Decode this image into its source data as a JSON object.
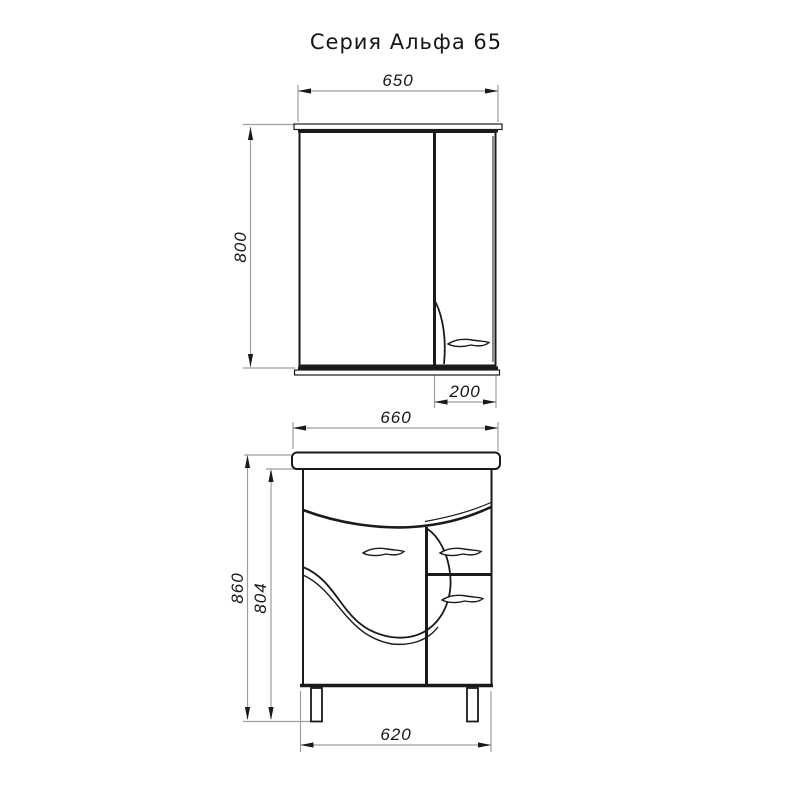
{
  "title": "Серия Альфа 65",
  "dimensions": {
    "mirror_width": "650",
    "mirror_height": "800",
    "mirror_side_cabinet_width": "200",
    "vanity_top_width": "660",
    "vanity_overall_height": "860",
    "vanity_body_height": "804",
    "vanity_base_width": "620"
  },
  "colors": {
    "line": "#1a1a1a",
    "dimension_line": "#9e9e9e",
    "background": "#ffffff"
  }
}
